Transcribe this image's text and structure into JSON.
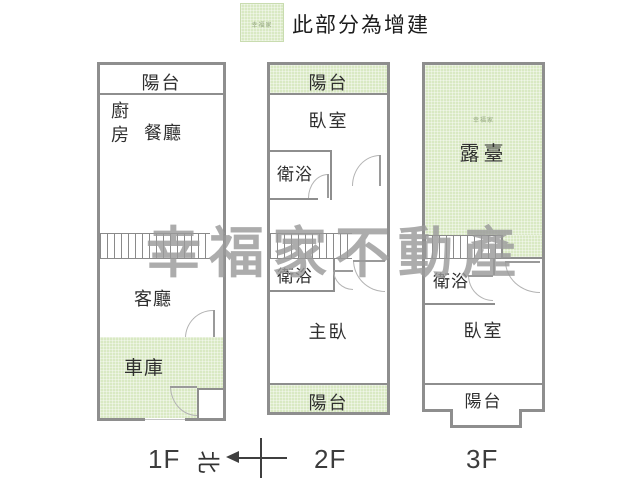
{
  "legend": {
    "label": "此部分為增建",
    "swatch_meaning": "addition-area"
  },
  "watermark": {
    "text": "幸福家不動產",
    "small": "幸福家"
  },
  "colors": {
    "addition_green": "#d9e9c3",
    "wall_gray": "#8e8e8e",
    "watermark_gray": "#9b9b9b"
  },
  "compass": {
    "north_label": "北"
  },
  "floors": [
    {
      "label": "1F",
      "rooms": {
        "balcony_top": "陽台",
        "kitchen": "廚房",
        "dining": "餐廳",
        "living": "客廳",
        "garage": "車庫"
      }
    },
    {
      "label": "2F",
      "rooms": {
        "balcony_top": "陽台",
        "bedroom": "臥室",
        "bath_upper": "衛浴",
        "bath_lower": "衛浴",
        "master_bedroom": "主臥",
        "balcony_bottom": "陽台"
      }
    },
    {
      "label": "3F",
      "rooms": {
        "terrace": "露臺",
        "bath": "衛浴",
        "bedroom": "臥室",
        "balcony_bottom": "陽台"
      }
    }
  ]
}
